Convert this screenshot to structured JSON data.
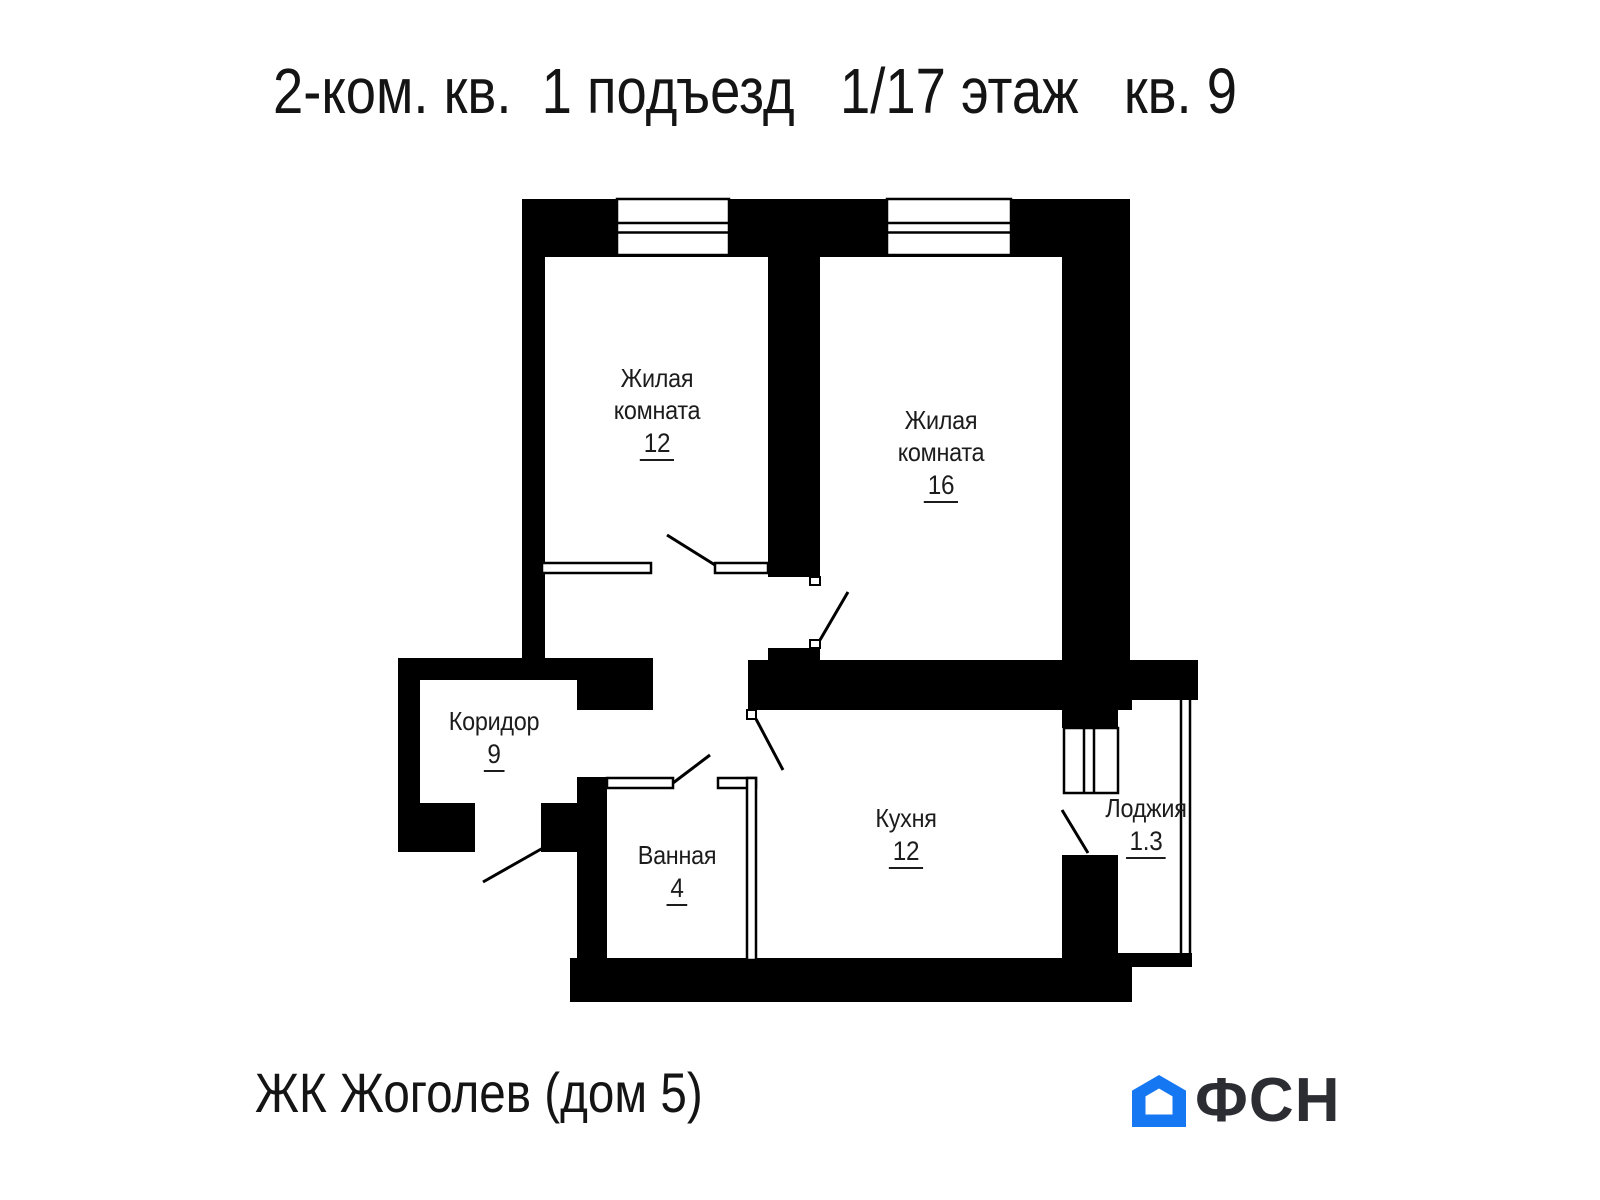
{
  "header": {
    "title": "2-ком. кв.  1 подъезд   1/17 этаж   кв. 9"
  },
  "plan": {
    "rooms": [
      {
        "key": "living-12",
        "line1": "Жилая",
        "line2": "комната",
        "area": "12"
      },
      {
        "key": "living-16",
        "line1": "Жилая",
        "line2": "комната",
        "area": "16"
      },
      {
        "key": "corridor",
        "line1": "Коридор",
        "line2": "",
        "area": "9"
      },
      {
        "key": "bathroom",
        "line1": "Ванная",
        "line2": "",
        "area": "4"
      },
      {
        "key": "kitchen",
        "line1": "Кухня",
        "line2": "",
        "area": "12"
      },
      {
        "key": "loggia",
        "line1": "Лоджия",
        "line2": "",
        "area": "1.3"
      }
    ]
  },
  "footer": {
    "project_name": "ЖК Жоголев (дом 5)",
    "logo_text": "ФСН"
  },
  "colors": {
    "wall": "#000000",
    "text": "#1a1a1a",
    "logo_blue": "#1677f2",
    "logo_dark": "#2b2d33"
  }
}
